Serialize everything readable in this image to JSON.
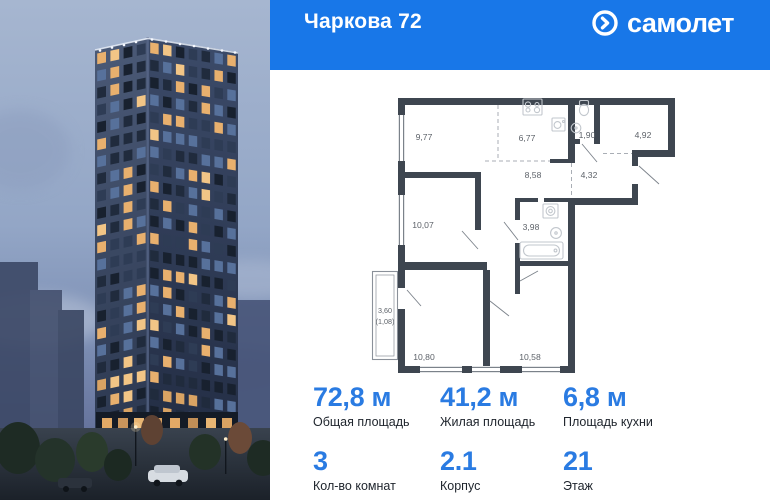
{
  "header": {
    "title": "Чаркова 72",
    "brand": "самолет",
    "brand_icon": "arrow-circle-icon"
  },
  "colors": {
    "header_bg": "#1877E8",
    "accent_blue": "#2A7BE2",
    "plan_wall": "#3E4650",
    "window_light": "#E8B06E"
  },
  "plan": {
    "room_labels": [
      {
        "text": "9,77",
        "x": 64,
        "y": 55
      },
      {
        "text": "6,77",
        "x": 167,
        "y": 56
      },
      {
        "text": "1,90",
        "x": 227,
        "y": 53
      },
      {
        "text": "4,92",
        "x": 283,
        "y": 53
      },
      {
        "text": "8,58",
        "x": 173,
        "y": 93
      },
      {
        "text": "4,32",
        "x": 229,
        "y": 93
      },
      {
        "text": "10,07",
        "x": 63,
        "y": 143
      },
      {
        "text": "3,98",
        "x": 171,
        "y": 145
      },
      {
        "text": "10,80",
        "x": 64,
        "y": 275
      },
      {
        "text": "10,58",
        "x": 170,
        "y": 275
      }
    ],
    "balcony_label": {
      "line1": "3,60",
      "line2": "(1,08)",
      "x": 25,
      "y": 228
    },
    "fixtures": [
      "stove-icon",
      "kitchen-sink-icon",
      "toilet-icon",
      "washbasin-icon",
      "washer-icon",
      "bathtub-icon"
    ]
  },
  "stats": {
    "items": [
      {
        "value": "72,8 м",
        "label": "Общая площадь"
      },
      {
        "value": "41,2 м",
        "label": "Жилая площадь"
      },
      {
        "value": "6,8 м",
        "label": "Площадь кухни"
      },
      {
        "value": "3",
        "label": "Кол-во комнат"
      },
      {
        "value": "2.1",
        "label": "Корпус"
      },
      {
        "value": "21",
        "label": "Этаж"
      }
    ]
  }
}
